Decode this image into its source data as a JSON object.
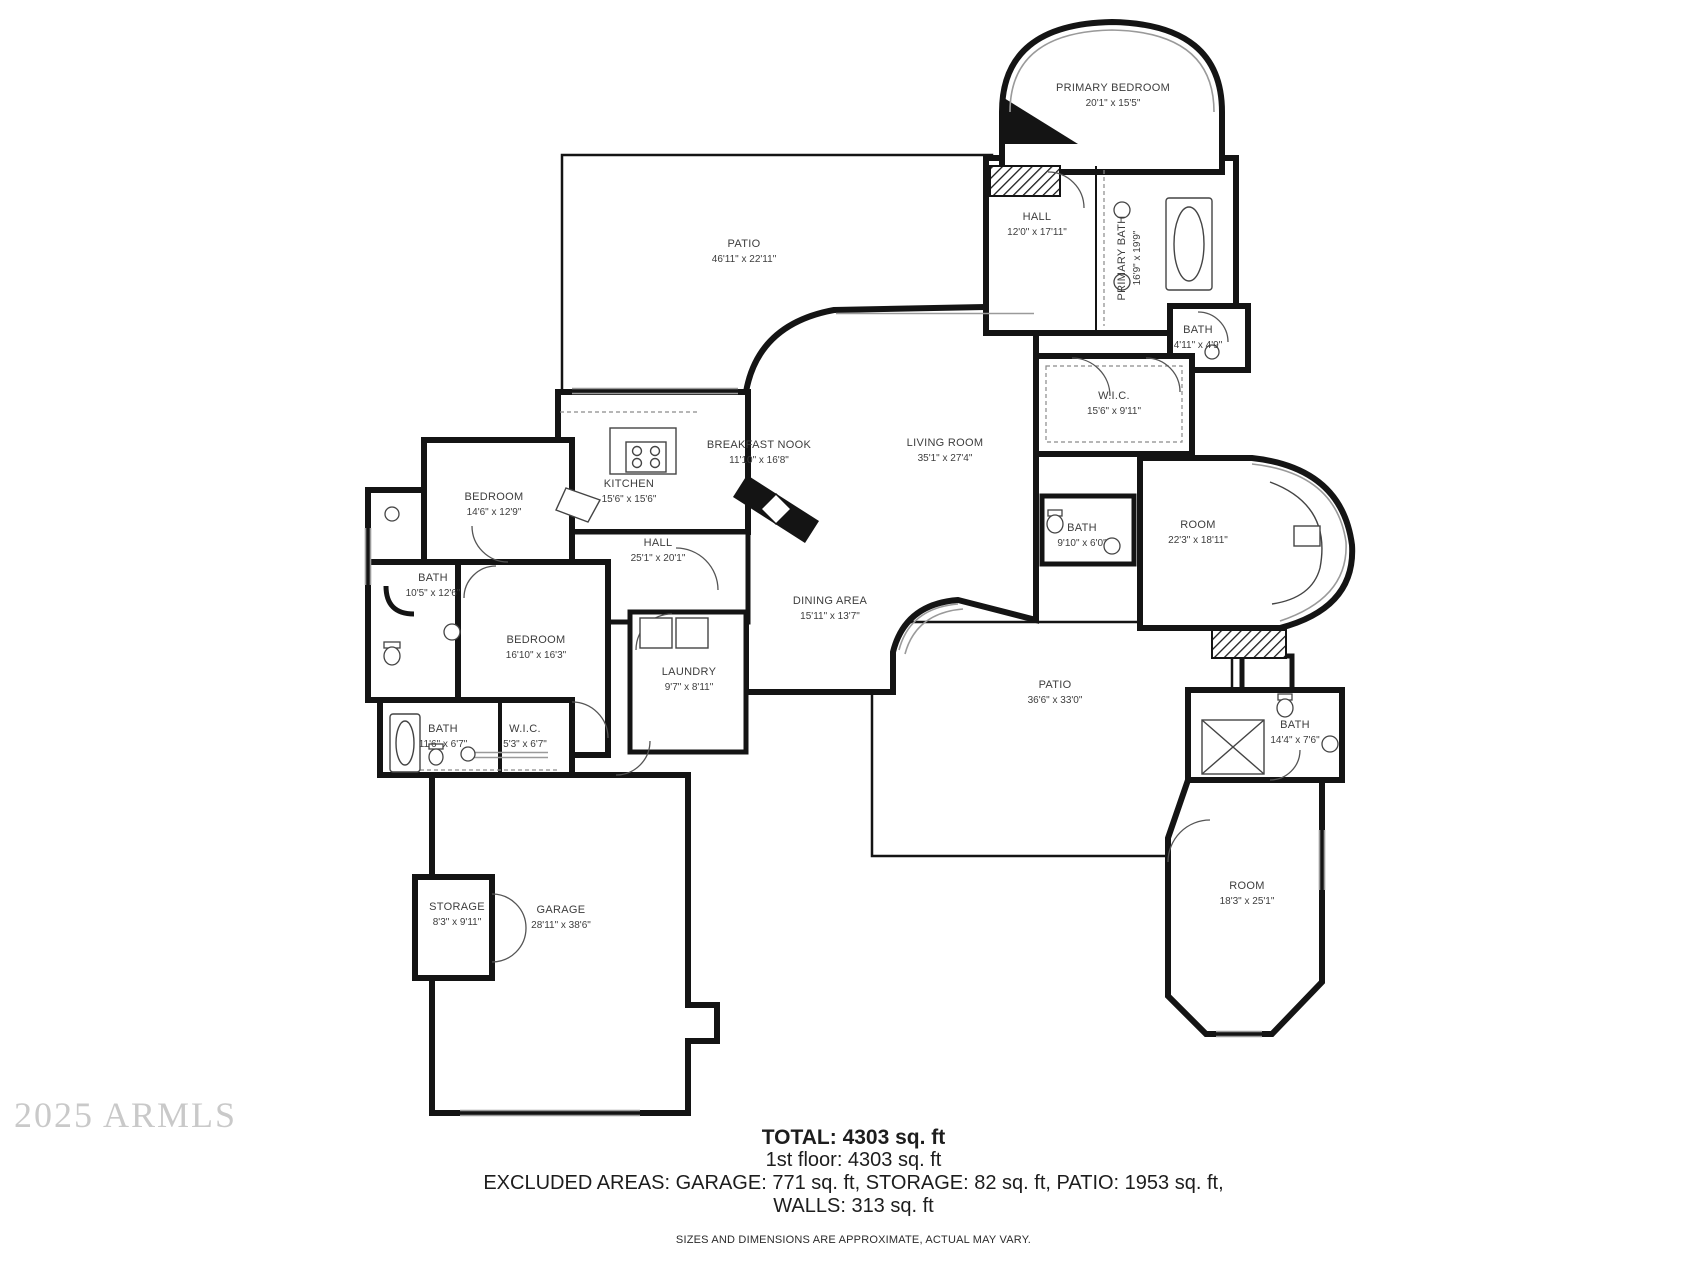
{
  "plan": {
    "rooms": [
      {
        "name": "PRIMARY BEDROOM",
        "dims": "20'1\" x 15'5\""
      },
      {
        "name": "HALL",
        "dims": "12'0\" x 17'11\""
      },
      {
        "name": "PRIMARY BATH",
        "dims": "16'9\" x 19'9\""
      },
      {
        "name": "PATIO",
        "dims": "46'11\" x 22'11\""
      },
      {
        "name": "BATH",
        "dims": "4'11\" x 4'9\""
      },
      {
        "name": "W.I.C.",
        "dims": "15'6\" x 9'11\""
      },
      {
        "name": "KITCHEN",
        "dims": "15'6\" x 15'6\""
      },
      {
        "name": "BREAKFAST NOOK",
        "dims": "11'10\" x 16'8\""
      },
      {
        "name": "LIVING ROOM",
        "dims": "35'1\" x 27'4\""
      },
      {
        "name": "BEDROOM",
        "dims": "14'6\" x 12'9\""
      },
      {
        "name": "BATH",
        "dims": "10'5\" x 12'6\""
      },
      {
        "name": "HALL",
        "dims": "25'1\" x 20'1\""
      },
      {
        "name": "BATH",
        "dims": "9'10\" x 6'0\""
      },
      {
        "name": "ROOM",
        "dims": "22'3\" x 18'11\""
      },
      {
        "name": "DINING AREA",
        "dims": "15'11\" x 13'7\""
      },
      {
        "name": "BEDROOM",
        "dims": "16'10\" x 16'3\""
      },
      {
        "name": "LAUNDRY",
        "dims": "9'7\" x 8'11\""
      },
      {
        "name": "PATIO",
        "dims": "36'6\" x 33'0\""
      },
      {
        "name": "BATH",
        "dims": "11'6\" x 6'7\""
      },
      {
        "name": "W.I.C.",
        "dims": "5'3\" x 6'7\""
      },
      {
        "name": "BATH",
        "dims": "14'4\" x 7'6\""
      },
      {
        "name": "STORAGE",
        "dims": "8'3\" x 9'11\""
      },
      {
        "name": "GARAGE",
        "dims": "28'11\" x 38'6\""
      },
      {
        "name": "ROOM",
        "dims": "18'3\" x 25'1\""
      }
    ],
    "footer": {
      "total": "TOTAL: 4303 sq. ft",
      "floor1": "1st floor: 4303 sq. ft",
      "excluded": "EXCLUDED AREAS: GARAGE: 771 sq. ft, STORAGE: 82 sq. ft, PATIO: 1953 sq. ft,",
      "walls": "WALLS: 313 sq. ft",
      "disclaimer": "SIZES AND DIMENSIONS ARE APPROXIMATE, ACTUAL MAY VARY."
    },
    "watermark": "2025 ARMLS",
    "colors": {
      "wall": "#141414",
      "label": "#3d3d3d",
      "watermark": "#c9c9c9"
    }
  }
}
